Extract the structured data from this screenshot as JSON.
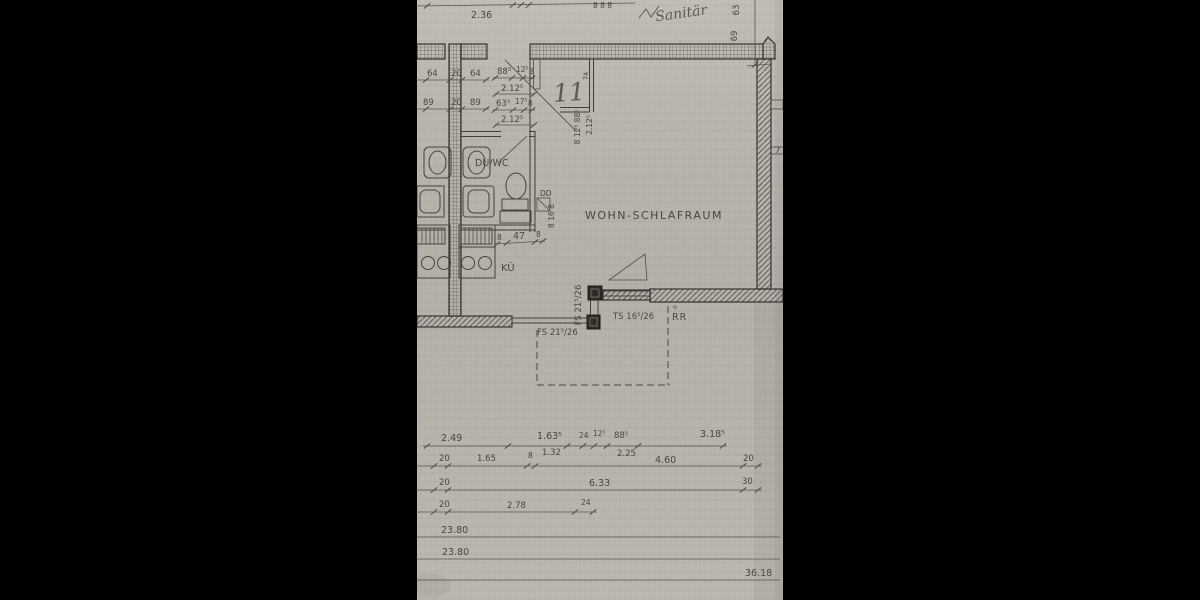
{
  "scene": {
    "description": "Scanned architectural floor plan of a one-room apartment, letterboxed with black bars",
    "background_color": "#000000",
    "paper_color": "#bdb9b1",
    "ink_color": "#3c3934"
  },
  "rooms": {
    "living": "WOHN-SCHLAFRAUM",
    "bath": "DU/WC",
    "kitchen": "KÜ"
  },
  "annotations": {
    "handwritten_word": "Sanitär",
    "handwritten_number": "11",
    "shaft_width": "74",
    "duct_label": "DD",
    "rain_pipe": "RR",
    "rain_pipe_marker": "o",
    "stub_number": "7"
  },
  "frames": {
    "window_vertical": "FS 21⁵/26",
    "window_horizontal": "FS 21⁵/26",
    "balcony_door": "TS 16⁵/26"
  },
  "dims": {
    "top": {
      "width": "2.36",
      "small": "8 8 8",
      "right_upper": "63",
      "right_lower": "69"
    },
    "upper_left": {
      "row1": [
        "64",
        "20",
        "64"
      ],
      "row1b": [
        "88⁵",
        "12⁵",
        "8"
      ],
      "row1_total": "2.12⁵",
      "row2": [
        "89",
        "20",
        "89"
      ],
      "row2b": [
        "63⁵",
        "17⁵",
        "8"
      ],
      "row2_total": "2.12⁵"
    },
    "shaft_vertical": {
      "parts": "8 12⁵ 88⁵",
      "total": "2.12⁵"
    },
    "duct_vertical": "8 16 8",
    "niche": [
      "8",
      "47",
      "8"
    ],
    "bottom": {
      "rowA": [
        "2.49",
        "1.63⁵",
        "24",
        "12⁵",
        "88⁵",
        "3.18⁵"
      ],
      "rowA_sub": [
        "1.32",
        "2.25"
      ],
      "rowB": [
        "20",
        "1.65",
        "8",
        "4.60",
        "20"
      ],
      "rowC": [
        "20",
        "6.33",
        "30"
      ],
      "rowD": [
        "20",
        "2.78",
        "24"
      ],
      "rowE": "23.80",
      "rowF": "23.80",
      "total": "36.18"
    }
  }
}
